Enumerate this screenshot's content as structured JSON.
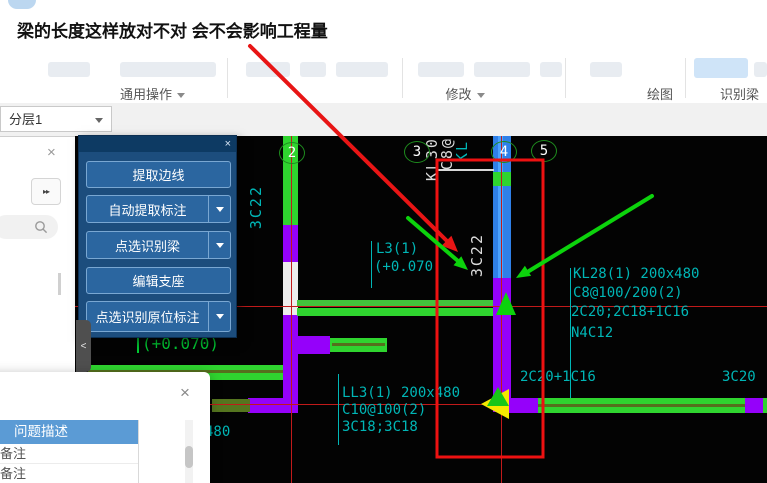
{
  "header": {
    "question_title": "梁的长度这样放对不对 会不会影响工程量"
  },
  "toolbar": {
    "groups": [
      {
        "label": "通用操作",
        "dropdown": true
      },
      {
        "label": "",
        "dropdown": false
      },
      {
        "label": "修改",
        "dropdown": true
      },
      {
        "label": "绘图",
        "dropdown": false
      },
      {
        "label": "识别梁",
        "dropdown": false
      }
    ]
  },
  "layer_bar": {
    "selected": "分层1"
  },
  "tool_panel": {
    "buttons": [
      {
        "label": "提取边线",
        "dropdown": false
      },
      {
        "label": "自动提取标注",
        "dropdown": true
      },
      {
        "label": "点选识别梁",
        "dropdown": true
      },
      {
        "label": "编辑支座",
        "dropdown": false
      },
      {
        "label": "点选识别原位标注",
        "dropdown": true
      }
    ]
  },
  "canvas": {
    "axis_bubbles": [
      "2",
      "3",
      "4",
      "5"
    ],
    "labels": {
      "col2_rebar": "3C22",
      "kl30_clipped": "KL30(",
      "c8_clipped": "C8@1",
      "kl_clipped": "KL",
      "col4_rebar": "3C22",
      "l3_name": "L3(1)",
      "l3_elev": "(+0.070)",
      "elev2": "(+0.070)",
      "kl28_line1": "KL28(1) 200x480",
      "kl28_line2": "C8@100/200(2)",
      "kl28_line3": "2C20;2C18+1C16",
      "kl28_line4": "N4C12",
      "top_rebar": "2C20+1C16",
      "right_rebar": "3C20",
      "ll3_line1": "LL3(1) 200x480",
      "ll3_line2": "C10@100(2)",
      "ll3_line3": "3C18;3C18",
      "dim_480": "480"
    }
  },
  "dialog": {
    "rows": [
      {
        "label": "问题描述",
        "selected": true
      },
      {
        "label": "备注",
        "selected": false
      },
      {
        "label": "备注",
        "selected": false
      }
    ]
  },
  "icons": {
    "close": "×",
    "collapse": "<",
    "expand": "▸▸"
  },
  "colors": {
    "annotation_red": "#e81515",
    "annotation_green": "#0cd30c",
    "cad_cyan": "#00b6b6",
    "beam_green": "#2fd42f",
    "column_purple": "#9501fa",
    "column_blue": "#2f80e8",
    "selected_row_blue": "#5b9bd5",
    "panel_blue": "#1c4d7d"
  }
}
